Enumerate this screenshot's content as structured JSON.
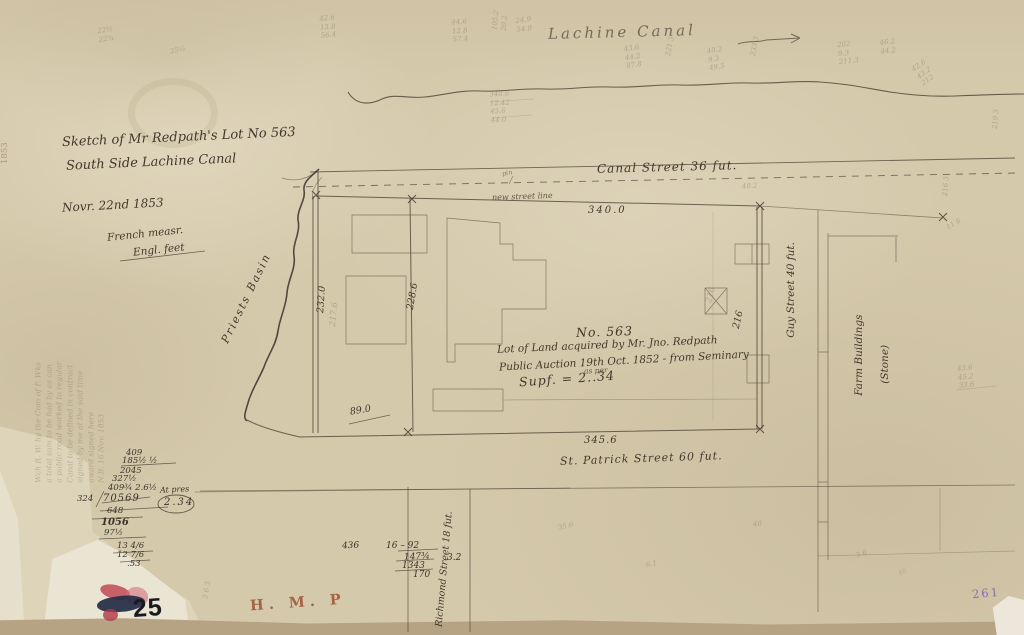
{
  "canal": {
    "name": "Lachine Canal"
  },
  "titles": {
    "sketch1": "Sketch of Mr Redpath's Lot No 563",
    "sketch2": "South Side Lachine Canal",
    "date": "Novr. 22nd 1853",
    "measure1": "French measr.",
    "measure2": "Engl. feet"
  },
  "streets": {
    "canal": "Canal Street 36 fut.",
    "street_line": "new street line",
    "st_patrick": "St. Patrick Street 60 fut.",
    "guy": "Guy Street 40 fut.",
    "richmond": "Richmond Street 18 fut."
  },
  "lot": {
    "no": "No. 563",
    "desc1": "Lot of Land acquired by Mr. Jno. Redpath",
    "desc2": "Public Auction 19th Oct. 1852 - from Seminary",
    "units": "as per",
    "area": "Supf. = 2..34",
    "dim_top": "340.0",
    "dim_bottom": "345.6",
    "dim_left": "232.0",
    "dim_left_pencil": "217.6",
    "dim_mid": "228.6",
    "dim_right": "216",
    "dim_right_pencil": "216",
    "dim_small": "89.0",
    "basin": "Priests Basin",
    "farm1": "Farm Buildings",
    "farm2": "(Stone)",
    "pin": "pin"
  },
  "margin_note": "Wch R. W. by the Com of P. Wks\na total sum to be had by as can\na public road worked to regular\nCanal to be defined in contract\nsigned by me at the said time\naward signed here\nN.B. 16 Nov. 1853",
  "calc_left": [
    "409",
    "185½  ½",
    "2045",
    "327½",
    "409¾  2.6½",
    "324",
    "70569",
    "At pres",
    "2.34",
    "648",
    "1056",
    "97½",
    "13 4/6",
    "12 7/6",
    ".53"
  ],
  "calc_mid": [
    "436",
    "16 – 92",
    "147¾",
    "1343",
    "170",
    "3.2"
  ],
  "pencil": [
    "22½\n22¾",
    "25½",
    "42.6\n13.8\n56.4",
    "44.6\n12.8\n57.4",
    "105.2\n20.2",
    "24.9\n54.9",
    "43.6\n44.2\n87.8",
    "221 3",
    "40.2\n9.3\n49.5",
    "233 3",
    "202\n9.3\n211.3",
    "46.2\n44.2",
    "42.6\n43.2\n212",
    "216 3",
    "219 3",
    "43.6\n45.2\n33.6",
    "340.6\n12.42\n45.6\n44.0",
    "11 6",
    "35.6",
    "6.1",
    "40",
    "3 6",
    "3 6 3",
    "40.2",
    "46"
  ],
  "stamps": {
    "number": "25",
    "hmp": "H. M. P",
    "purple": "261",
    "year": "1853"
  },
  "colors": {
    "ink": "#4a4132",
    "pencil": "#8a7f6a",
    "stamp_red": "#a04f33",
    "stamp_purple": "#7a5fae",
    "paper": "#d5c9ac"
  }
}
